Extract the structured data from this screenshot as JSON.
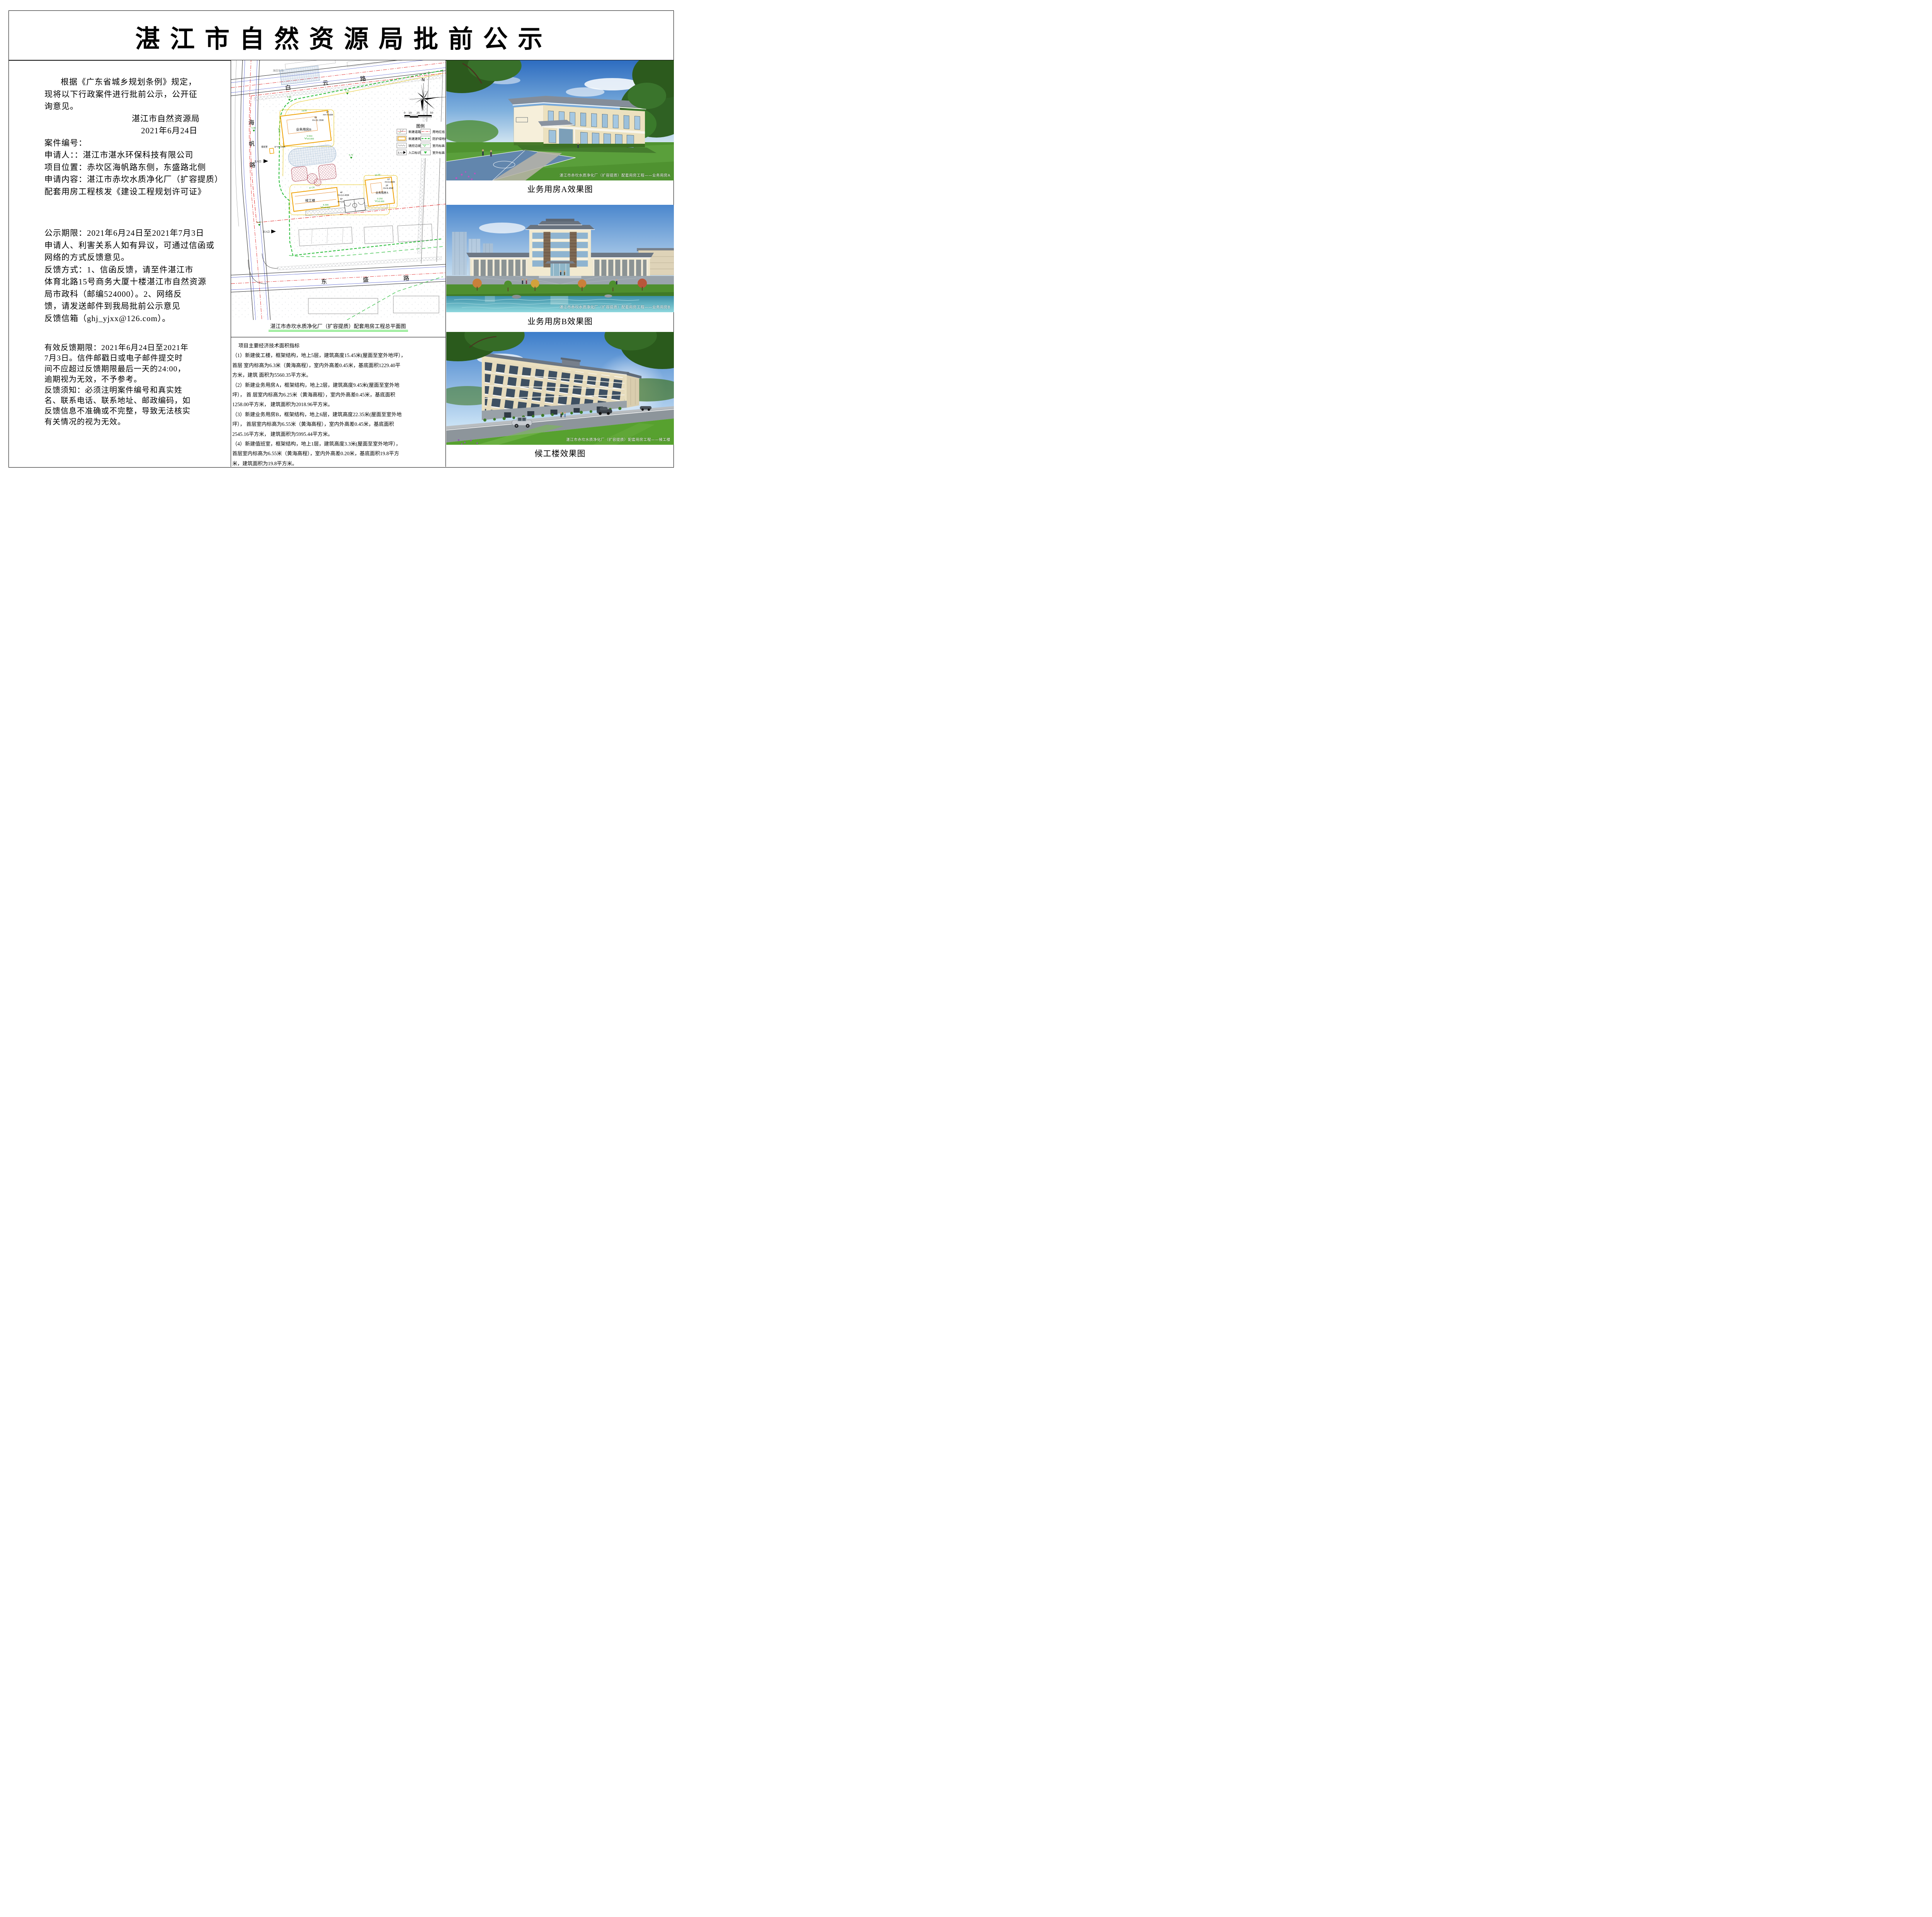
{
  "title": "湛江市自然资源局批前公示",
  "left": {
    "lines": [
      "根据《广东省城乡规划条例》规定，",
      "现将以下行政案件进行批前公示，公开征",
      "询意见。",
      "湛江市自然资源局",
      "2021年6月24日",
      "案件编号：",
      "申请人：：湛江市湛水环保科技有限公司",
      "项目位置：赤坎区海帆路东侧，东盛路北侧",
      "申请内容：湛江市赤坎水质净化厂（扩容提质）",
      "配套用房工程核发《建设工程规划许可证》",
      "公示期限：2021年6月24日至2021年7月3日",
      "申请人、利害关系人如有异议，可通过信函或",
      "网络的方式反馈意见。",
      "反馈方式：1、信函反馈，请至件湛江市",
      "体育北路15号商务大厦十楼湛江市自然资源",
      "局市政科（邮编524000）。2、网络反",
      "馈，请发送邮件到我局批前公示意见",
      "反馈信箱（ghj_yjxx@126.com）。",
      "有效反馈期限：2021年6月24日至2021年",
      "7月3日。信件邮戳日或电子邮件提交时",
      "间不应超过反馈期限最后一天的24:00，",
      "逾期视为无效，不予参考。",
      "反馈须知：必须注明案件编号和真实姓",
      "名、联系电话、联系地址、邮政编码，如",
      "反馈信息不准确或不完整，导致无法核实",
      "有关情况的视为无效。"
    ]
  },
  "plan": {
    "caption": "湛江市赤坎水质净化厂（扩容提质）配套用房工程总平面图",
    "north": "N",
    "site_label": "海田车场",
    "roads": {
      "baiyun": [
        "白",
        "云",
        "路"
      ],
      "haifan": [
        "海",
        "帆",
        "路"
      ],
      "dongsheng": [
        "东",
        "盛",
        "路"
      ]
    },
    "scale": {
      "ticks": [
        "0",
        "10",
        "25",
        "50"
      ]
    },
    "legend": {
      "title": "图例",
      "items": [
        {
          "label": "新建道路"
        },
        {
          "label": "新建建筑"
        },
        {
          "label": "填挖边坡"
        },
        {
          "label": "入口标识"
        },
        {
          "label": "用地红线"
        },
        {
          "label": "防护绿地线"
        },
        {
          "label": "室内标高"
        },
        {
          "label": "室外标高"
        }
      ],
      "entrance_sym": "主入口"
    },
    "buildings": {
      "b": {
        "name": "业务用房B",
        "f1": "6F",
        "h1": "H=22.35M",
        "f2": "1F",
        "h2": "H=7.55M",
        "lv": "5.553",
        "pm": "±0.000"
      },
      "a": {
        "name": "业务用房A",
        "f1": "1F",
        "h1": "H=4.95M",
        "f2": "2F",
        "h2": "H=9.45M",
        "lv": "0.250",
        "pm": "±0.000"
      },
      "h": {
        "name": "候工楼",
        "f1": "4F",
        "h1": "H=12.45M",
        "f2": "5F",
        "h2": "H=15.45M",
        "lv": "6.300",
        "pm": "±0.000"
      },
      "z": {
        "name": "值班室",
        "ann": "1F H=3.6M"
      }
    },
    "entr_main": "主入口",
    "entr_sec": "次入口",
    "dims": [
      "74.00",
      "38.00",
      "34.00",
      "67.20"
    ],
    "spots": [
      "5.95",
      "5.88",
      "5.75",
      "5.80",
      "5.73"
    ]
  },
  "tech": {
    "heading": "项目主要经济技术面积指标",
    "lines": [
      "（1）新建侯工楼，框架结构，地上5层，建筑高度15.45米(屋面至室外地坪），",
      "首层 室内标高为6.3米（黄海高程），室内外高差0.45米，基底面积1229.40平",
      "方米，建筑 面积为5560.35平方米。",
      "（2）新建业务用房A，框架结构，地上2层，建筑高度9.45米(屋面至室外地",
      "坪）， 首 层室内标高为6.25米（黄海高程），室内外高差0.45米，基底面积",
      "1258.00平方米， 建筑面积为2018.96平方米。",
      "（3）新建业务用房B，框架结构，地上6层，建筑高度22.35米(屋面至室外地",
      "坪）， 首层室内标高为6.55米（黄海高程），室内外高差0.45米，基底面积",
      "2545.16平方米， 建筑面积为5995.44平方米。",
      "（4）新建值班室，框架结构，地上1层，建筑高度3.3米(屋面至室外地坪），",
      "首层室内标高为6.55米（黄海高程），室内外高差0.20米，基底面积19.8平方",
      "米，建筑面积为19.8平方米。"
    ]
  },
  "figures": [
    {
      "caption": "业务用房A效果图",
      "watermark": "湛江市赤坎水质净化厂（扩容提质）配套用房工程——业务用房A"
    },
    {
      "caption": "业务用房B效果图",
      "watermark": "湛江市赤坎水质净化厂（扩容提质）配套用房工程——业务用房B"
    },
    {
      "caption": "候工楼效果图",
      "watermark": "湛江市赤坎水质净化厂（扩容提质）配套用房工程——候工楼"
    }
  ],
  "colors": {
    "green_line": "#2fbf3f",
    "red_line": "#e02222",
    "building_outline": "#f0a000",
    "caption_underline": "#00cf00"
  }
}
